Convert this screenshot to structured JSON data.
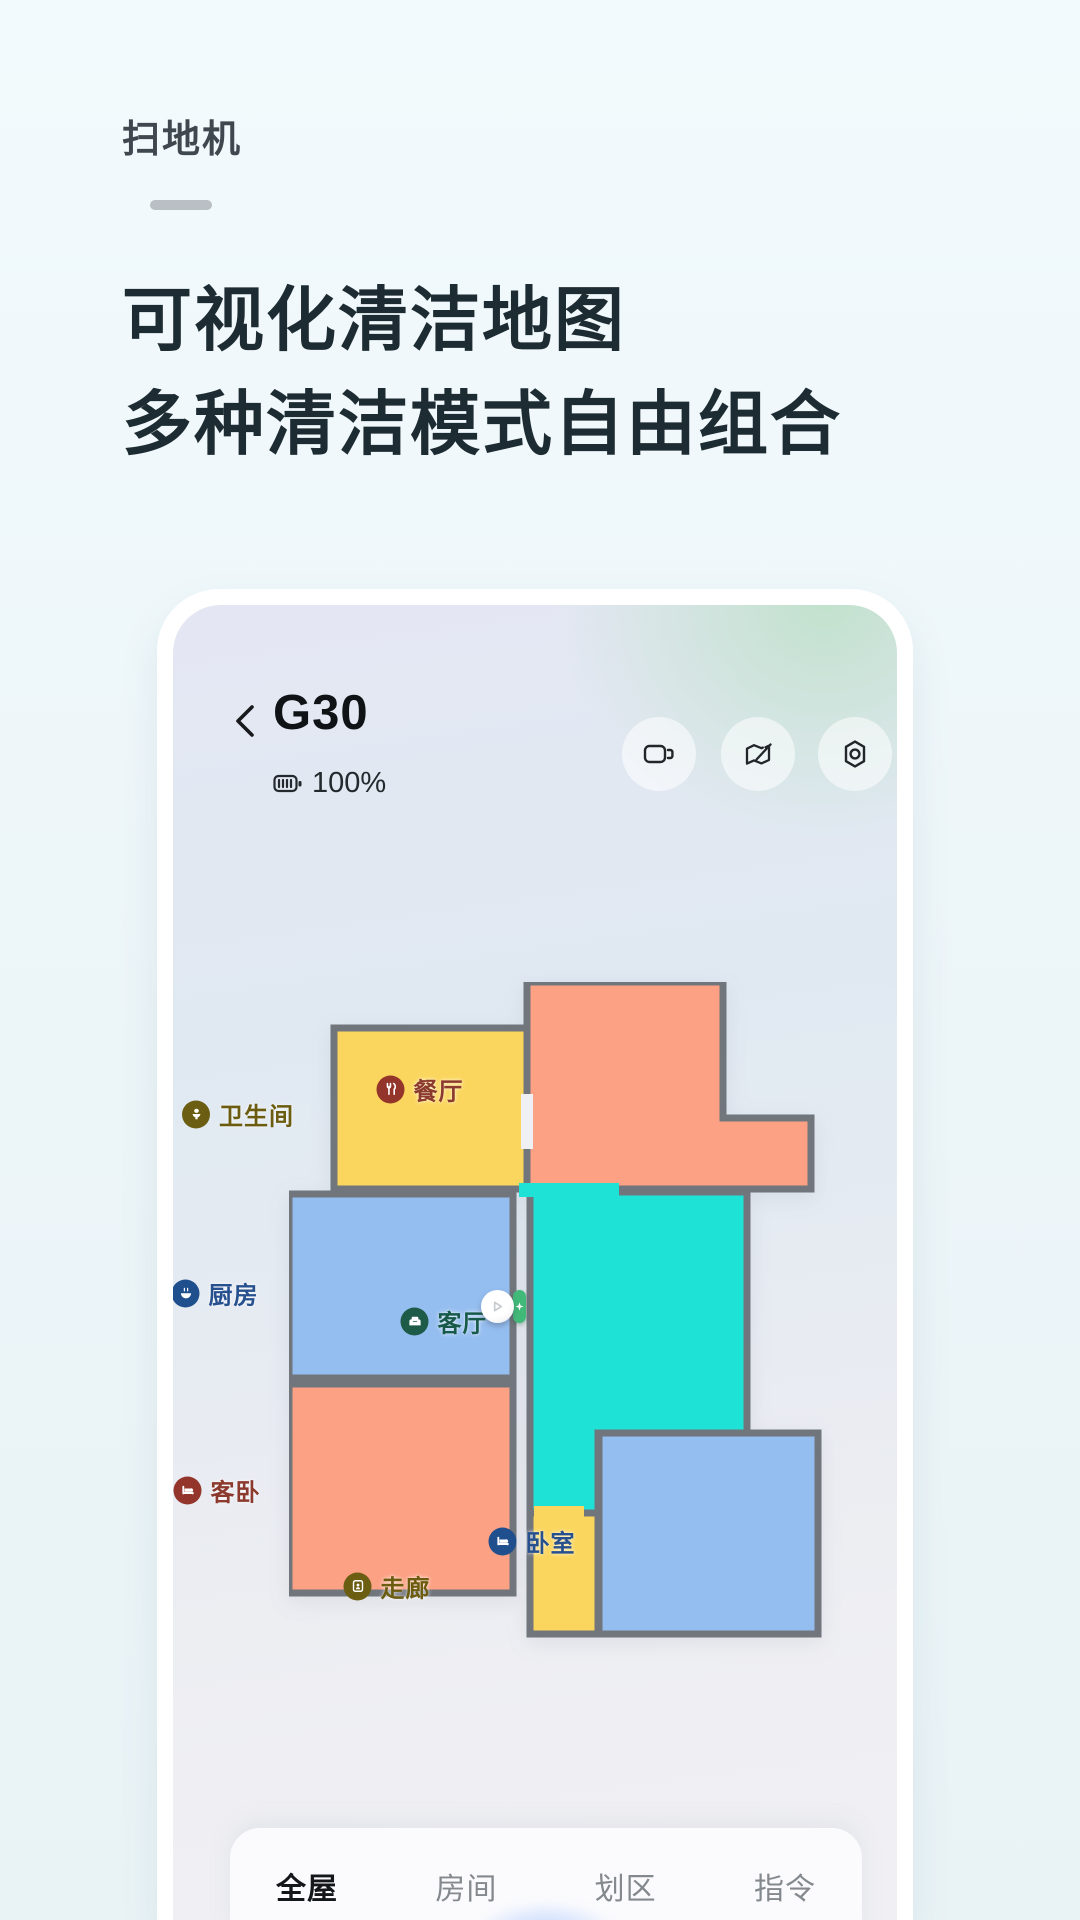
{
  "page": {
    "eyebrow": "扫地机",
    "headline1": "可视化清洁地图",
    "headline2": "多种清洁模式自由组合"
  },
  "device": {
    "name": "G30",
    "battery": "100%"
  },
  "toolbar": {
    "icons": [
      "video-camera",
      "map-edit",
      "settings"
    ]
  },
  "map": {
    "wall_color": "#71767d",
    "background_gap_color": "#eef0f4",
    "rooms": [
      {
        "id": "dining",
        "label": "餐厅",
        "fill": "#FCA183",
        "badge_color": "#93352B",
        "text_color": "#8C3A2E",
        "icon": "cutlery-icon"
      },
      {
        "id": "bathroom",
        "label": "卫生间",
        "fill": "#FBD65E",
        "badge_color": "#6B5E12",
        "text_color": "#6B5C0F",
        "icon": "toilet-icon"
      },
      {
        "id": "kitchen",
        "label": "厨房",
        "fill": "#95BEF0",
        "badge_color": "#1F4F8D",
        "text_color": "#27508F",
        "icon": "bowl-icon"
      },
      {
        "id": "living",
        "label": "客厅",
        "fill": "#1FE2D6",
        "badge_color": "#1D5A47",
        "text_color": "#175A4A",
        "icon": "sofa-icon"
      },
      {
        "id": "guest-bedroom",
        "label": "客卧",
        "fill": "#FCA183",
        "badge_color": "#93352B",
        "text_color": "#8C3A2E",
        "icon": "bed-icon"
      },
      {
        "id": "corridor",
        "label": "走廊",
        "fill": "#FBD65E",
        "badge_color": "#6B5E12",
        "text_color": "#6B5C0F",
        "icon": "door-icon"
      },
      {
        "id": "bedroom",
        "label": "卧室",
        "fill": "#95BEF0",
        "badge_color": "#1F4F8D",
        "text_color": "#27508F",
        "icon": "bed-icon"
      }
    ],
    "robot": {
      "dock_color": "#41B979"
    }
  },
  "tabs": [
    {
      "label": "全屋",
      "active": true
    },
    {
      "label": "房间",
      "active": false
    },
    {
      "label": "划区",
      "active": false
    },
    {
      "label": "指令",
      "active": false
    }
  ],
  "accent": "#2B7CFF"
}
